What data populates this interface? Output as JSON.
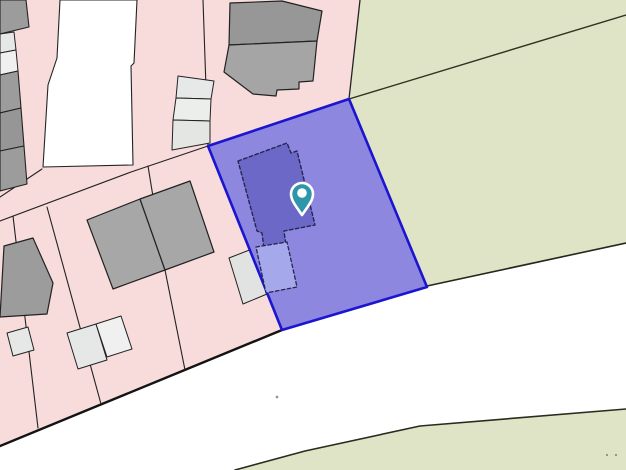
{
  "map": {
    "kind": "cadastral-parcel-map",
    "background_color": "#ffffff",
    "colors": {
      "residential_land": "#f8dbdb",
      "field": "#dfe4c6",
      "road": "#ffffff",
      "building": "#a0a0a0",
      "outbuilding": "#e6e8e7",
      "lot_line": "#222222",
      "selected_parcel_fill": "#8d87e0",
      "selected_parcel_border": "#1c15d0",
      "selected_parcel_building": "#6b68c7",
      "selected_parcel_outbuilding": "#a6a8ec",
      "marker_teal": "#2f95ab"
    },
    "features": [
      {
        "name": "residential-land-area",
        "type": "polygon",
        "points": "0,0 360,0 349,99 208,146 282,330 0,446",
        "fill": "#f8dbdb",
        "interactable": false
      },
      {
        "name": "field-area-north",
        "type": "polygon",
        "points": "360,0 626,0 626,243 427,286 349,99",
        "fill": "#dfe4c6",
        "interactable": false
      },
      {
        "name": "field-area-south",
        "type": "polygon",
        "points": "235,470 305,451 420,426 626,409 626,470",
        "fill": "#dfe4c6",
        "interactable": false
      },
      {
        "name": "driveway-parcel",
        "type": "polygon",
        "points": "60,0 137,0 134,63 131,66 133,165 43,167 48,85 57,58",
        "fill": "#ffffff",
        "stroke": "#242424",
        "strokeWidth": 1.1,
        "interactable": false
      },
      {
        "name": "lot-line-field-boundary-top",
        "type": "polyline",
        "points": "360,0 349,99",
        "stroke": "#242424",
        "strokeWidth": 1.3,
        "interactable": false
      },
      {
        "name": "lot-line-field-diagonal",
        "type": "polyline",
        "points": "349,99 626,15",
        "stroke": "#31311f",
        "strokeWidth": 1.4,
        "interactable": false
      },
      {
        "name": "road-edge-northeast",
        "type": "polyline",
        "points": "427,286 626,243",
        "stroke": "#26261c",
        "strokeWidth": 1.6,
        "interactable": false
      },
      {
        "name": "road-edge-south-field",
        "type": "polyline",
        "points": "235,470 305,451 420,426 626,409",
        "stroke": "#2a2a1e",
        "strokeWidth": 1.6,
        "interactable": false
      },
      {
        "name": "road-edge-southwest",
        "type": "polyline",
        "points": "282,330 0,446",
        "stroke": "#131313",
        "strokeWidth": 2.4,
        "interactable": false
      },
      {
        "name": "lot-line-1",
        "type": "polyline",
        "points": "0,221 131,172 208,146",
        "stroke": "#222222",
        "strokeWidth": 1.1,
        "interactable": false
      },
      {
        "name": "lot-line-2",
        "type": "polyline",
        "points": "42,169 0,197",
        "stroke": "#222222",
        "strokeWidth": 1.1,
        "interactable": false
      },
      {
        "name": "lot-line-3",
        "type": "polyline",
        "points": "47,207 101,404",
        "stroke": "#222222",
        "strokeWidth": 1.1,
        "interactable": false
      },
      {
        "name": "lot-line-4",
        "type": "polyline",
        "points": "13,216 38,428",
        "stroke": "#222222",
        "strokeWidth": 1.1,
        "interactable": false
      },
      {
        "name": "lot-line-5",
        "type": "polyline",
        "points": "148,166 165,270 185,370",
        "stroke": "#222222",
        "strokeWidth": 1.1,
        "interactable": false
      },
      {
        "name": "lot-line-6",
        "type": "polyline",
        "points": "203,0 208,146",
        "stroke": "#222222",
        "strokeWidth": 1.1,
        "interactable": false
      },
      {
        "name": "building-west-1",
        "type": "polygon",
        "points": "0,0 26,0 29,27 0,34",
        "fill": "#9c9c9c",
        "stroke": "#222222",
        "strokeWidth": 1.1,
        "interactable": false
      },
      {
        "name": "outbuilding-west-1",
        "type": "polygon",
        "points": "0,34 14,32 16,50 0,53",
        "fill": "#e6e8e7",
        "stroke": "#222222",
        "strokeWidth": 1,
        "interactable": false
      },
      {
        "name": "outbuilding-west-2",
        "type": "polygon",
        "points": "0,53 16,50 18,71 0,75",
        "fill": "#eff0ef",
        "stroke": "#222222",
        "strokeWidth": 1,
        "interactable": false
      },
      {
        "name": "building-west-2",
        "type": "polygon",
        "points": "0,75 18,71 21,108 0,113",
        "fill": "#9c9c9c",
        "stroke": "#222222",
        "strokeWidth": 1.1,
        "interactable": false
      },
      {
        "name": "building-west-3",
        "type": "polygon",
        "points": "0,113 21,108 24,146 0,151",
        "fill": "#969696",
        "stroke": "#222222",
        "strokeWidth": 1.1,
        "interactable": false
      },
      {
        "name": "building-west-4",
        "type": "polygon",
        "points": "0,151 24,146 27,184 0,191",
        "fill": "#9c9c9c",
        "stroke": "#222222",
        "strokeWidth": 1.1,
        "interactable": false
      },
      {
        "name": "building-north-upper",
        "type": "polygon",
        "points": "230,3 282,1 322,11 317,41 229,45",
        "fill": "#979797",
        "stroke": "#222222",
        "strokeWidth": 1.2,
        "interactable": false
      },
      {
        "name": "building-north-lower",
        "type": "polygon",
        "points": "229,45 317,41 313,81 299,82 299,89 277,90 276,96 253,94 224,72",
        "fill": "#a5a5a5",
        "stroke": "#222222",
        "strokeWidth": 1.2,
        "interactable": false
      },
      {
        "name": "shed-row-1",
        "type": "polygon",
        "points": "178,76 214,81 211,99 176,98",
        "fill": "#e7e9e8",
        "stroke": "#222222",
        "strokeWidth": 1,
        "interactable": false
      },
      {
        "name": "shed-row-2",
        "type": "polygon",
        "points": "176,98 211,99 210,121 173,120",
        "fill": "#eceeec",
        "stroke": "#222222",
        "strokeWidth": 1,
        "interactable": false
      },
      {
        "name": "shed-row-3",
        "type": "polygon",
        "points": "173,120 210,121 210,143 172,150",
        "fill": "#e4e6e4",
        "stroke": "#222222",
        "strokeWidth": 1,
        "interactable": false
      },
      {
        "name": "house-left",
        "type": "polygon",
        "points": "87,220 140,199 165,270 113,289",
        "fill": "#a7a7a7",
        "stroke": "#222222",
        "strokeWidth": 1.2,
        "interactable": false
      },
      {
        "name": "house-right",
        "type": "polygon",
        "points": "140,199 190,181 214,252 165,270",
        "fill": "#a7a7a7",
        "stroke": "#222222",
        "strokeWidth": 1.2,
        "interactable": false
      },
      {
        "name": "building-southwest",
        "type": "polygon",
        "points": "4,246 33,238 53,283 47,314 0,317",
        "fill": "#9c9c9c",
        "stroke": "#222222",
        "strokeWidth": 1.2,
        "interactable": false
      },
      {
        "name": "outbuilding-southwest-small",
        "type": "polygon",
        "points": "7,333 28,327 34,350 13,356",
        "fill": "#e6e8e7",
        "stroke": "#222222",
        "strokeWidth": 1,
        "interactable": false
      },
      {
        "name": "outbuilding-south-pair-left",
        "type": "polygon",
        "points": "67,333 96,324 107,360 78,369",
        "fill": "#e6e8e7",
        "stroke": "#222222",
        "strokeWidth": 1,
        "interactable": false
      },
      {
        "name": "outbuilding-south-pair-right",
        "type": "polygon",
        "points": "96,324 121,316 132,349 107,357",
        "fill": "#eff0ef",
        "stroke": "#222222",
        "strokeWidth": 1,
        "interactable": false
      },
      {
        "name": "outbuilding-near-parcel",
        "type": "polygon",
        "points": "229,258 252,249 267,294 243,304",
        "fill": "#e1e3e2",
        "stroke": "#222222",
        "strokeWidth": 1,
        "interactable": false
      },
      {
        "name": "road-speck-1",
        "type": "circle",
        "cx": 277,
        "cy": 397,
        "r": 1.4,
        "fill": "#9a9a9a",
        "interactable": false
      },
      {
        "name": "road-speck-2",
        "type": "circle",
        "cx": 607,
        "cy": 455,
        "r": 1.1,
        "fill": "#8e8e7c",
        "interactable": false
      },
      {
        "name": "road-speck-3",
        "type": "circle",
        "cx": 616,
        "cy": 455,
        "r": 1.1,
        "fill": "#8e8e7c",
        "interactable": false
      },
      {
        "name": "selected-parcel",
        "type": "polygon",
        "points": "349,99 427,287 282,330 208,146",
        "fill": "#8d87e0",
        "stroke": "#1c15d0",
        "strokeWidth": 2.6,
        "interactable": true
      },
      {
        "name": "selected-parcel-building",
        "type": "polygon",
        "points": "238,161 287,143 291,153 297,151 315,225 284,231 286,246 264,249 262,233 257,231",
        "fill": "#6b68c7",
        "stroke": "#26264f",
        "strokeWidth": 1.4,
        "dash": "3.5 2.5",
        "interactable": false
      },
      {
        "name": "selected-parcel-outbuilding",
        "type": "polygon",
        "points": "256,247 287,242 297,287 266,293",
        "fill": "#a6a8ec",
        "stroke": "#26264f",
        "strokeWidth": 1.3,
        "dash": "3.5 2.5",
        "interactable": false
      }
    ],
    "marker": {
      "icon": "location-pin-icon",
      "x": 302,
      "y": 194,
      "r": 11,
      "tip": 21,
      "color": "#2f95ab",
      "ring": "#ffffff",
      "inner_r": 4.8
    }
  }
}
